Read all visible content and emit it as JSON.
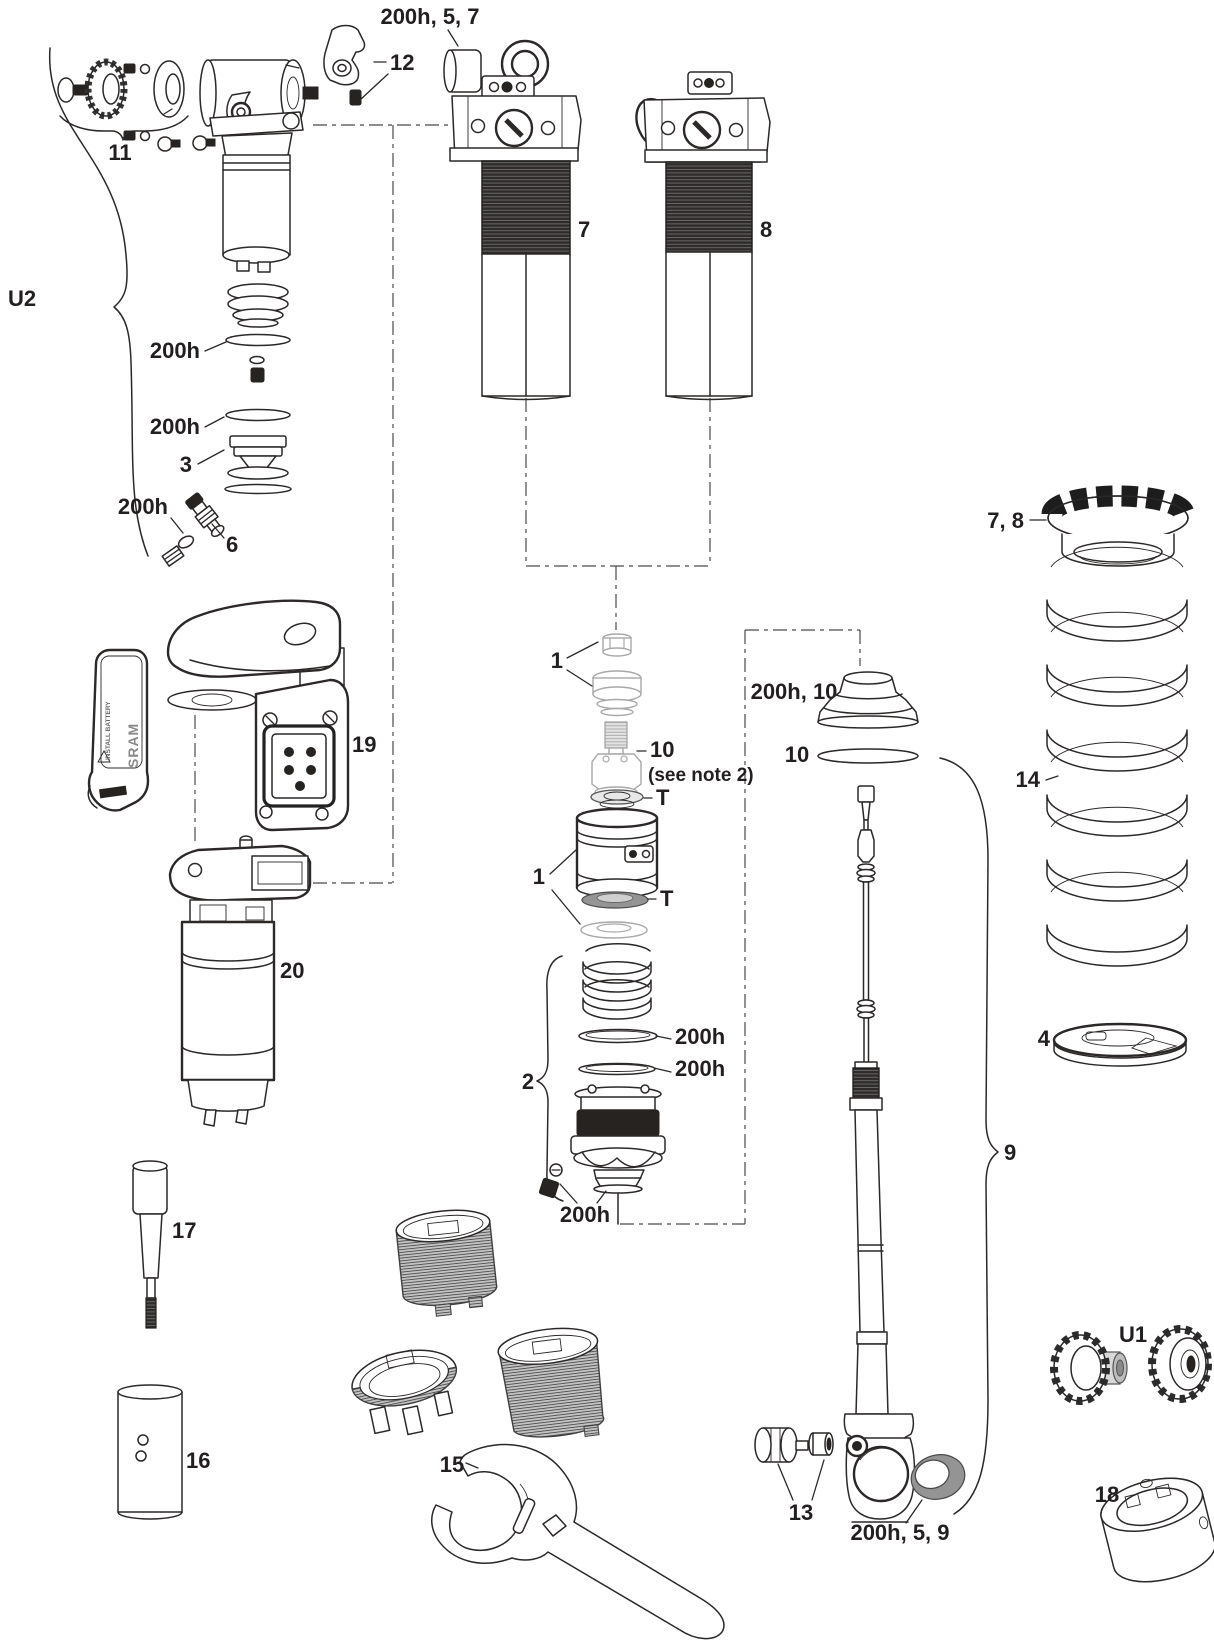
{
  "doc": {
    "kind": "exploded-parts-diagram",
    "subject": "rear shock service diagram"
  },
  "colors": {
    "line": "#2b2827",
    "dark_fill": "#262321",
    "ghost": "#a8a8a8",
    "background": "#ffffff"
  },
  "callouts": {
    "kit_200h_5_7": "200h, 5, 7",
    "lever_12": "12",
    "hardware_11": "11",
    "group_u2": "U2",
    "oring_a_200h": "200h",
    "oring_b_200h": "200h",
    "piston_3": "3",
    "oring_c_200h": "200h",
    "valve_6": "6",
    "shock_7": "7",
    "shock_8": "8",
    "motor_19": "19",
    "reservoir_20": "20",
    "sealhead_1a": "1",
    "adapter_10": "10",
    "adapter_note": "(see note 2)",
    "tool_t_a": "T",
    "assembly_1b": "1",
    "tool_t_b": "T",
    "internals_2": "2",
    "oring_d_200h": "200h",
    "oring_e_200h": "200h",
    "oring_f_200h": "200h",
    "bumper_200h_10": "200h, 10",
    "washer_10": "10",
    "collar_7_8": "7, 8",
    "spring_14": "14",
    "seat_4": "4",
    "shaft_9": "9",
    "nut_13": "13",
    "bushing_200h_5_9": "200h, 5, 9",
    "knobs_u1": "U1",
    "tool_18": "18",
    "tool_17": "17",
    "tool_16": "16",
    "wrench_15": "15"
  },
  "battery_cover": {
    "brand": "SRAM",
    "warning": "INSTALL BATTERY"
  }
}
